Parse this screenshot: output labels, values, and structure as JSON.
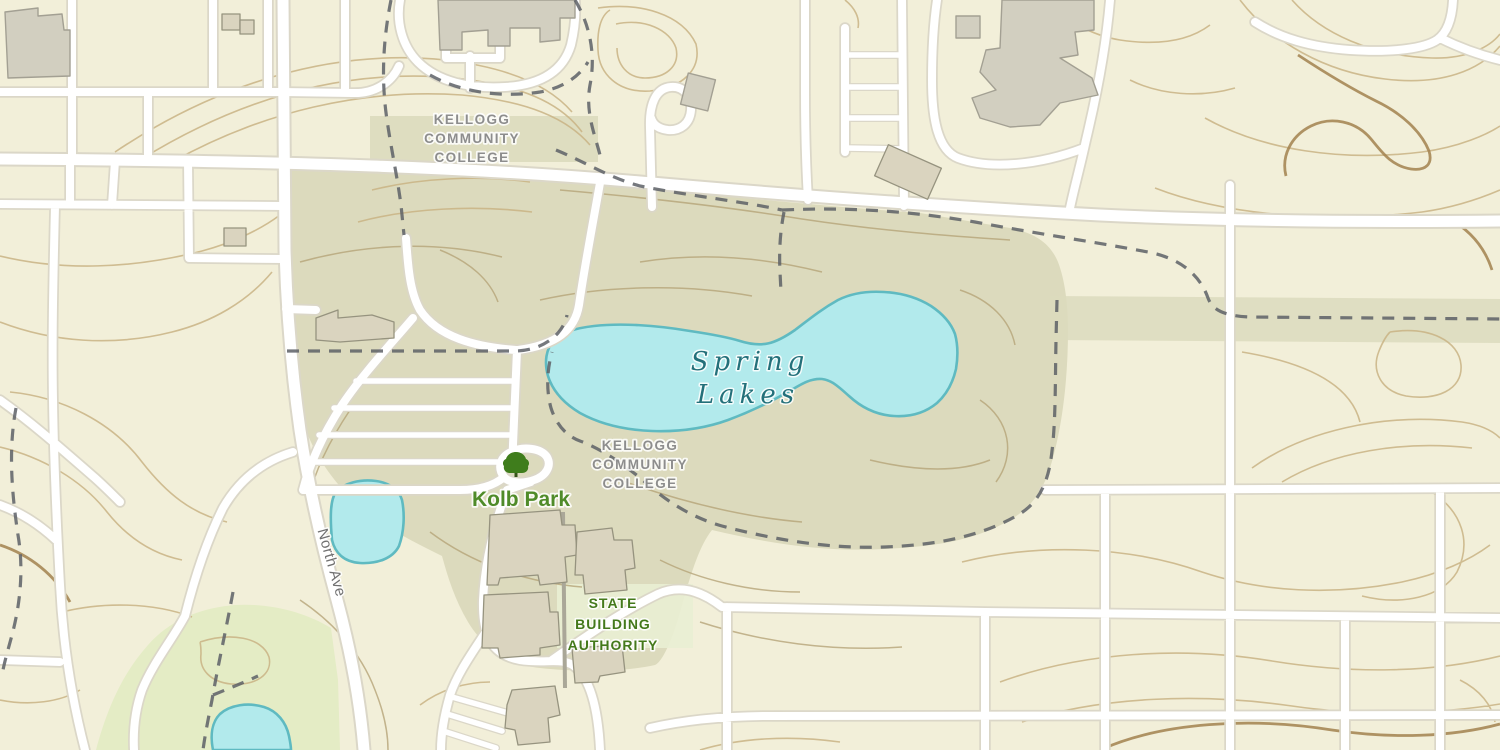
{
  "map": {
    "labels": {
      "college_north": {
        "lines": [
          "KELLOGG",
          "COMMUNITY",
          "COLLEGE"
        ]
      },
      "college_south": {
        "lines": [
          "KELLOGG",
          "COMMUNITY",
          "COLLEGE"
        ]
      },
      "lake": {
        "lines": [
          "Spring",
          "Lakes"
        ]
      },
      "park": {
        "text": "Kolb Park"
      },
      "authority": {
        "lines": [
          "STATE",
          "BUILDING",
          "AUTHORITY"
        ]
      },
      "road": {
        "text": "North Ave"
      }
    },
    "colors": {
      "background": "#f2efd9",
      "campus": "#dcdabd",
      "park_green": "#e4ecc5",
      "parcel": "#e9eed3",
      "water_fill": "#b2eaec",
      "water_stroke": "#5fbac1",
      "road_fill": "#ffffff",
      "road_casing": "#dbd7c8",
      "trail": "#5d6066",
      "contour": "#c9b384",
      "contour_index": "#a2814e",
      "building_gray": "#d2cfc0",
      "building_tan": "#dad4bf",
      "label_gray": "#8d8d8d",
      "label_water": "#23707a",
      "label_park": "#4f8b29",
      "label_authority": "#44791b",
      "label_road": "#707070",
      "tree_icon": "#3f7d1c"
    }
  }
}
